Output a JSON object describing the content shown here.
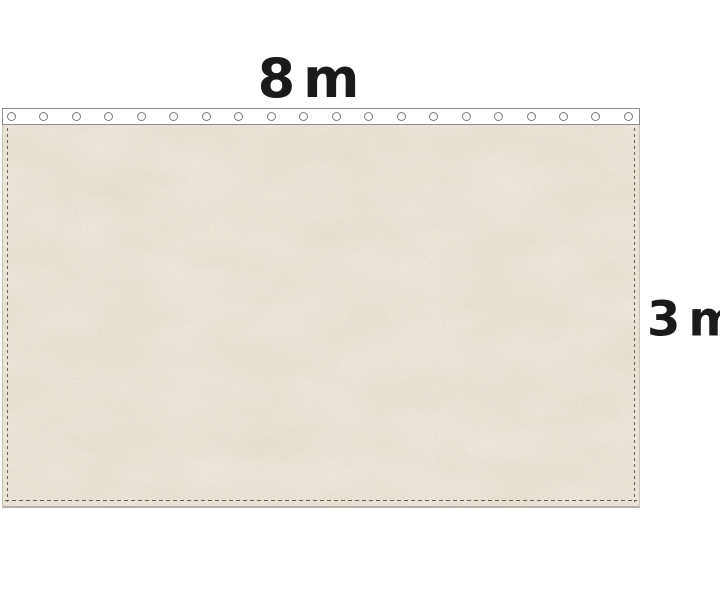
{
  "product": {
    "dimensions": {
      "width": {
        "value": "8",
        "unit": "m"
      },
      "height": {
        "value": "3",
        "unit": "m"
      }
    },
    "header_band": {
      "eyelet_count": 20
    }
  },
  "colors": {
    "page_bg": "#ffffff",
    "label": "#1a1a1a",
    "fabric_base": "#f1ebe0",
    "fabric_edge": "#c9c4b8",
    "fabric_bottom_edge": "#b3b0a8",
    "band_bg": "#ffffff",
    "band_border": "#8e8e8e",
    "eyelet_ring": "#7b7b7b",
    "stitch": "#6a6357"
  }
}
